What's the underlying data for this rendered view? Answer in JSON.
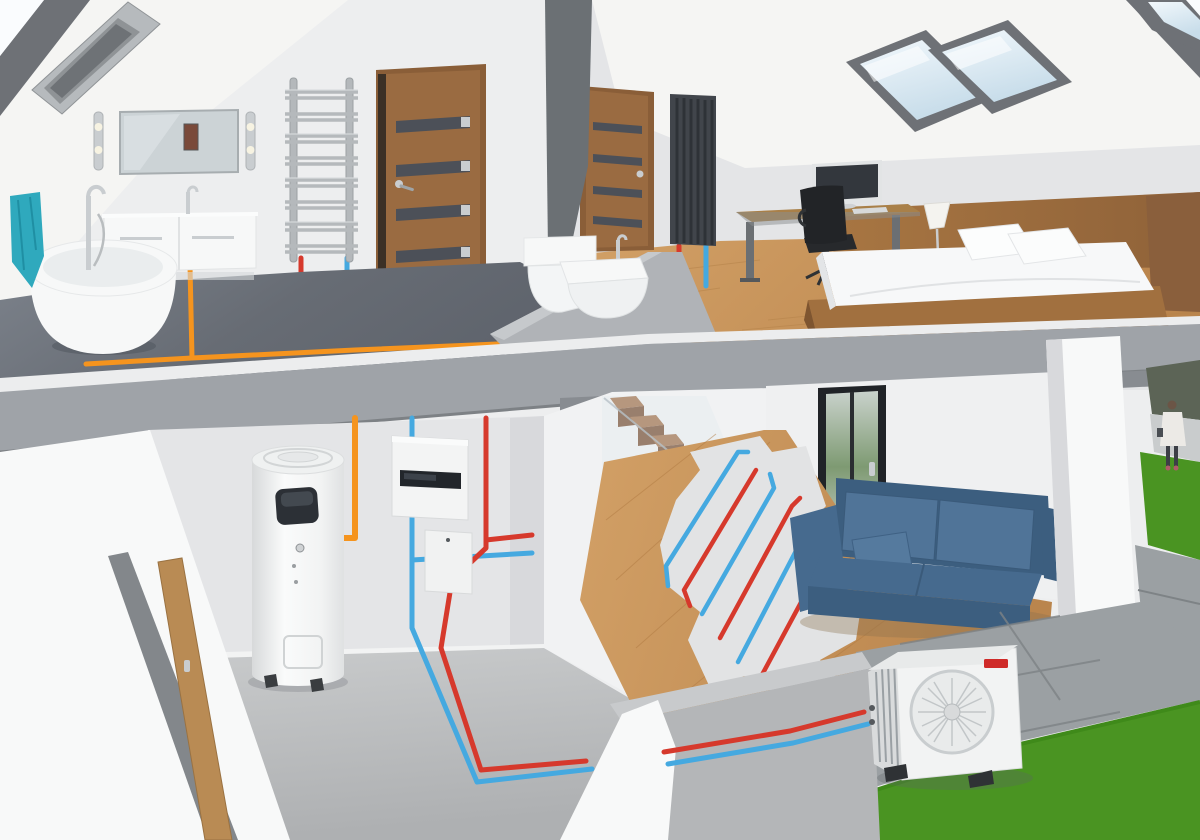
{
  "scene": {
    "description": "3D cutaway render of a two-story house showing a heat pump heating and hot water system",
    "floors": {
      "upper": [
        "bathroom with freestanding bathtub, vanity, mirror, towel-ladder radiator, toilet, bidet",
        "bedroom with skylights, desk, office chair, monitor, platform bed, black panel radiator"
      ],
      "ground": [
        "utility room with heat-pump water heater cylinder and two hydraulic wall units",
        "staircase with glass balustrade",
        "living room with blue sofa, glass door and exposed underfloor heating coils"
      ],
      "outside": [
        "outdoor heat pump unit with fan on paving slabs",
        "lawn",
        "paved path",
        "pedestrian in white coat"
      ]
    },
    "objects": [
      {
        "name": "skylight-window",
        "count": 3
      },
      {
        "name": "ceiling-radiant-heater"
      },
      {
        "name": "bathroom-mirror"
      },
      {
        "name": "wall-lamp",
        "count": 2
      },
      {
        "name": "vanity-cabinet"
      },
      {
        "name": "freestanding-bathtub"
      },
      {
        "name": "towel-ladder-radiator"
      },
      {
        "name": "interior-door",
        "count": 2
      },
      {
        "name": "wall-hung-toilet"
      },
      {
        "name": "bidet"
      },
      {
        "name": "black-vertical-radiator"
      },
      {
        "name": "platform-bed"
      },
      {
        "name": "desk-with-monitor"
      },
      {
        "name": "office-chair"
      },
      {
        "name": "table-lamp"
      },
      {
        "name": "heat-pump-water-heater"
      },
      {
        "name": "hydraulic-wall-unit",
        "count": 2
      },
      {
        "name": "staircase"
      },
      {
        "name": "glass-door"
      },
      {
        "name": "blue-sofa"
      },
      {
        "name": "underfloor-heating-coils"
      },
      {
        "name": "outdoor-heat-pump-unit"
      },
      {
        "name": "brand-logo-badge",
        "text_legible": false
      }
    ],
    "pipes": {
      "orange": "domestic hot water distribution on upper floor",
      "red": "heating flow (hot)",
      "blue": "heating return (cold)"
    }
  },
  "colors": {
    "sky": "#FAFCFE",
    "roof_cut": "#6E7176",
    "ceiling": "#F5F5F3",
    "wall_light": "#EDEEEF",
    "wall_mid": "#E4E5E7",
    "wall_shadow": "#D8D9DC",
    "wall_bright": "#F8F9F9",
    "partition": "#6B7074",
    "floor_bath": "#6E737B",
    "slab_face": "#9FA3A8",
    "slab_top": "#ECEDEE",
    "floor_concrete": "#BEC0C2",
    "wood_floor": "#C8955C",
    "wood_dark": "#8A5F3C",
    "door_wood": "#9A6B41",
    "door_frame": "#8A5E38",
    "glass_strip": "#4C5058",
    "radiator_gray": "#B4B8BB",
    "radiator_black": "#41454B",
    "fixture_white": "#F7F8F8",
    "fixture_shade": "#E4E6E8",
    "chrome": "#C9CDD0",
    "screed": "#E2E3E4",
    "sofa_dark": "#3C5E7F",
    "sofa_mid": "#466A8E",
    "sofa_light": "#507498",
    "grass": "#4A9422",
    "paving": "#9BA0A3",
    "paving_dark": "#7E8386",
    "towel_teal": "#2FA9BD",
    "dark": "#2A2D31",
    "stair_wood": "#A5744E",
    "stair_riser": "#7C5236",
    "pipe_orange": "#F5941E",
    "pipe_red": "#D6392C",
    "pipe_blue": "#45A9E0"
  }
}
